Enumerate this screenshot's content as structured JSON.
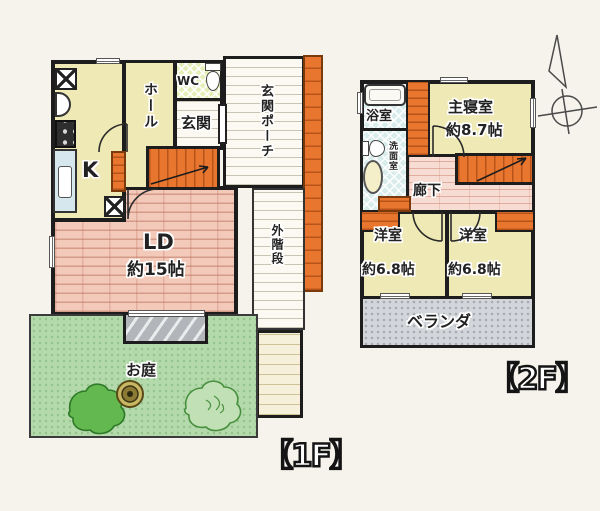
{
  "floor1": {
    "title": "【1F】",
    "kitchen": "K",
    "hall": "ホール",
    "wc": "WC",
    "entrance": "玄関",
    "entrance_porch": "玄関ポーチ",
    "living_dining": "LD",
    "living_dining_size": "約15帖",
    "outer_stairs": "外階段",
    "garden": "お庭"
  },
  "floor2": {
    "title": "【2F】",
    "bathroom": "浴室",
    "washroom": "洗面室",
    "master_bedroom": "主寝室",
    "master_bedroom_size": "約8.7帖",
    "corridor": "廊下",
    "western_room_left": "洋室",
    "western_room_left_size": "約6.8帖",
    "western_room_right": "洋室",
    "western_room_right_size": "約6.8帖",
    "veranda": "ベランダ"
  },
  "colors": {
    "wall": "#1d1d1d",
    "room_yellow": "#efe9b5",
    "flooring_pink": "#f3c9b9",
    "accent_orange": "#e9762f",
    "garden_green": "#b4daac",
    "tile_blue": "#d8eceb",
    "wc_floor_green": "#e4eeb6",
    "veranda_gray": "#d2d6da"
  }
}
